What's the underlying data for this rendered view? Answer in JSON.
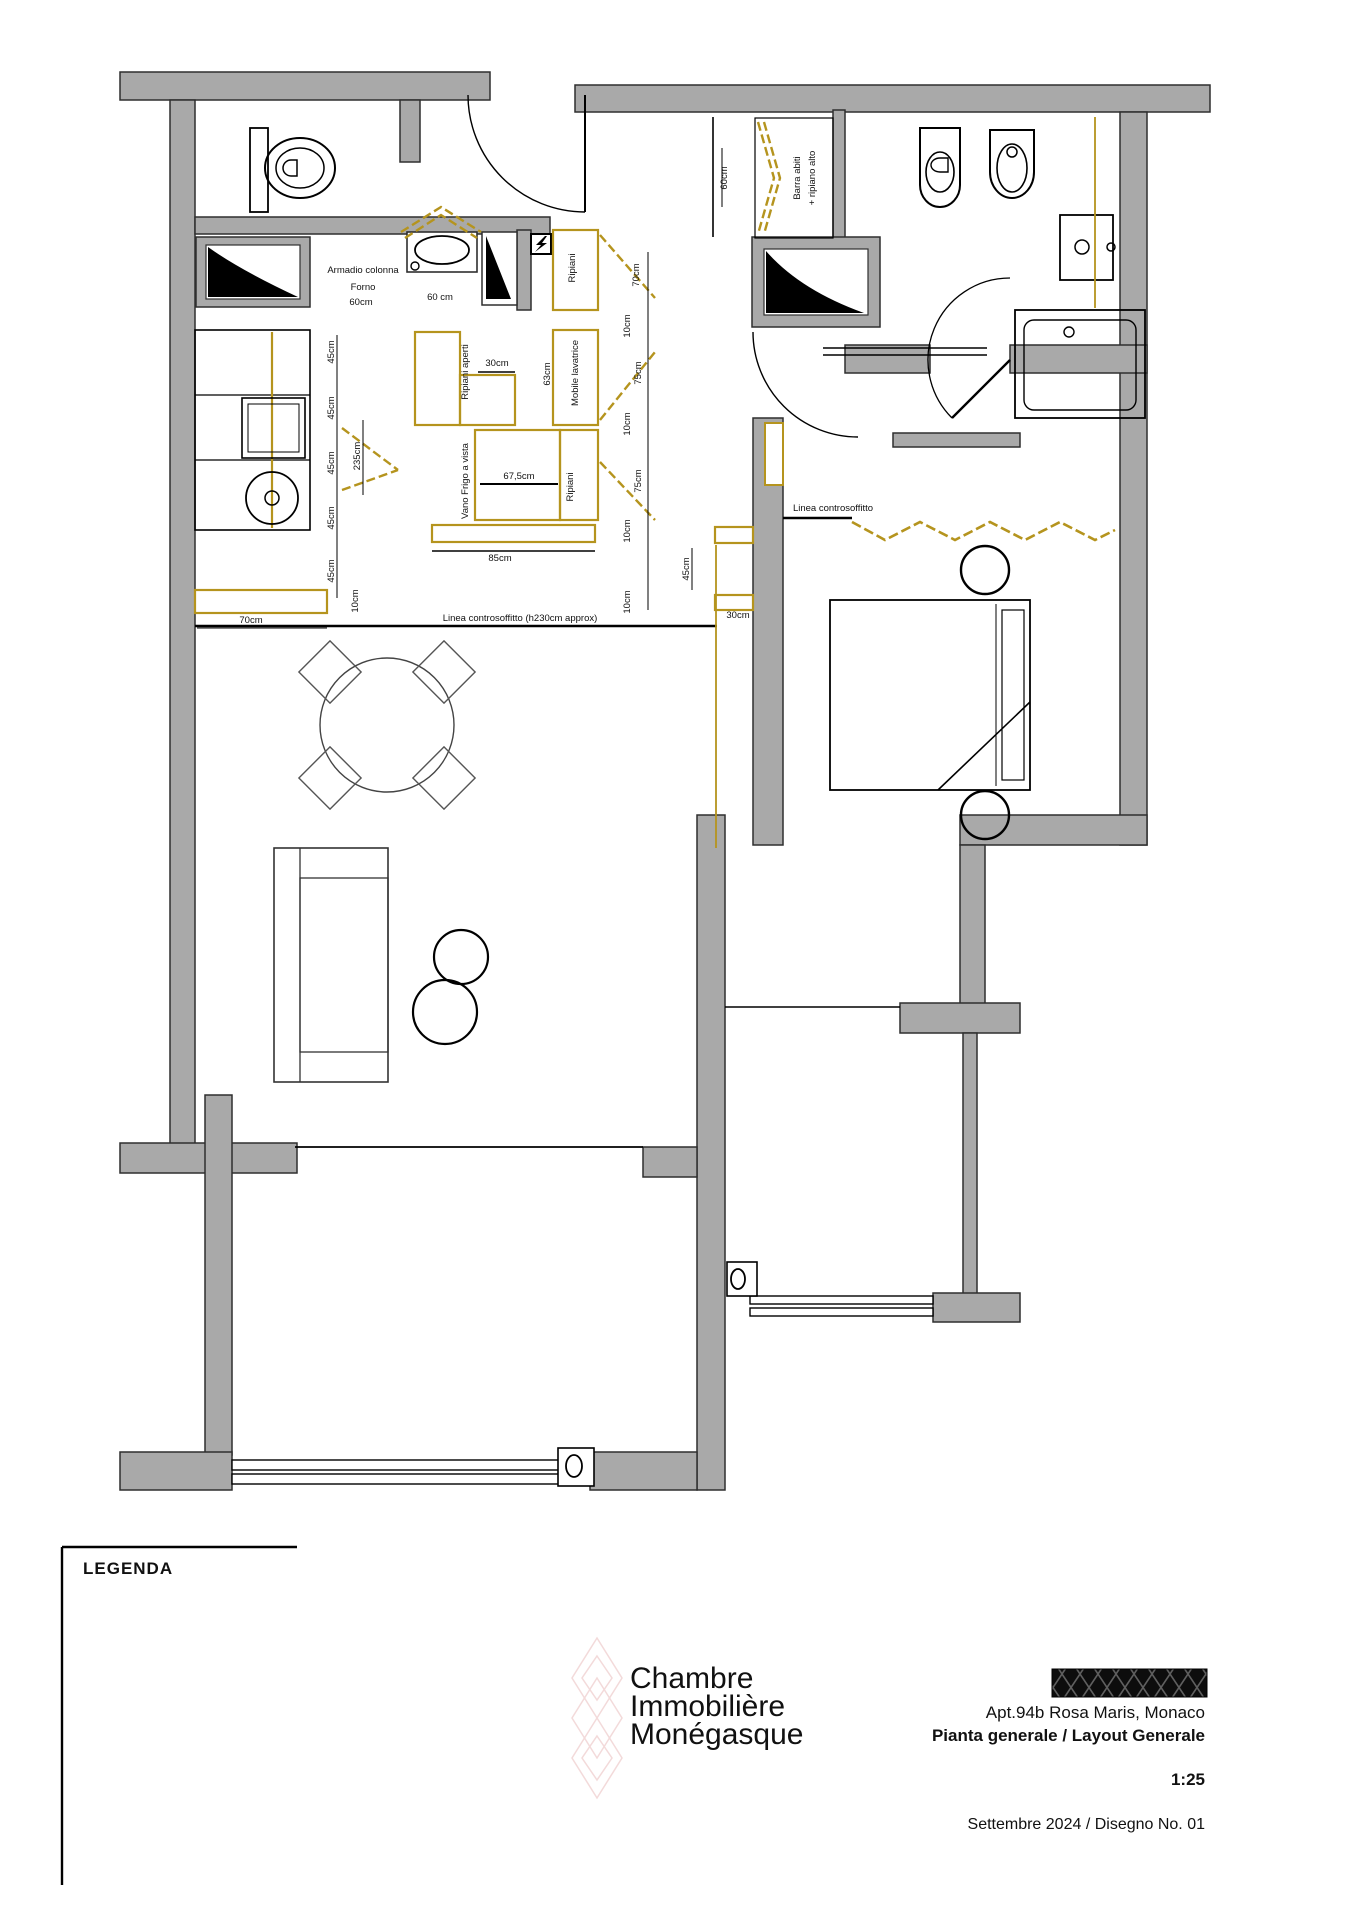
{
  "title_block": {
    "project": "Apt.94b Rosa Maris, Monaco",
    "drawing_title": "Pianta generale / Layout Generale",
    "scale": "1:25",
    "issue": "Settembre 2024 / Disegno No. 01"
  },
  "legend": {
    "title": "LEGENDA"
  },
  "watermark": {
    "line1": "Chambre",
    "line2": "Immobilière",
    "line3": "Monégasque"
  },
  "colors": {
    "wall_fill": "#a9a9a9",
    "wall_stroke": "#2f2f2f",
    "cabinet_gold": "#b5941e",
    "duct_black": "#000000",
    "watermark_pink": "#f2dcdc",
    "paper": "#ffffff"
  },
  "rooms": {
    "bathroom1": "bagno 1",
    "kitchen": "cucina",
    "entry": "ingresso",
    "closet": "guardaroba",
    "bathroom2": "bagno 2",
    "living": "soggiorno",
    "bedroom": "camera",
    "balcony1": "terrazza 1",
    "balcony2": "terrazza 2"
  },
  "plan_labels": [
    {
      "text": "Armadio colonna",
      "x": 363,
      "y": 273
    },
    {
      "text": "Forno",
      "x": 363,
      "y": 290
    },
    {
      "text": "60cm",
      "x": 361,
      "y": 305
    },
    {
      "text": "60 cm",
      "x": 440,
      "y": 300
    },
    {
      "text": "Ripiani",
      "x": 575,
      "y": 268,
      "rot": -90
    },
    {
      "text": "Ripiani aperti",
      "x": 468,
      "y": 372,
      "rot": -90
    },
    {
      "text": "30cm",
      "x": 497,
      "y": 366
    },
    {
      "text": "63cm",
      "x": 550,
      "y": 374,
      "rot": -90
    },
    {
      "text": "Mobile lavatrice",
      "x": 578,
      "y": 373,
      "rot": -90
    },
    {
      "text": "Vano Frigo a vista",
      "x": 468,
      "y": 481,
      "rot": -90
    },
    {
      "text": "67,5cm",
      "x": 519,
      "y": 479
    },
    {
      "text": "Ripiani",
      "x": 573,
      "y": 487,
      "rot": -90
    },
    {
      "text": "85cm",
      "x": 500,
      "y": 561
    },
    {
      "text": "45cm",
      "x": 334,
      "y": 352,
      "rot": -90
    },
    {
      "text": "45cm",
      "x": 334,
      "y": 408,
      "rot": -90
    },
    {
      "text": "45cm",
      "x": 334,
      "y": 463,
      "rot": -90
    },
    {
      "text": "45cm",
      "x": 334,
      "y": 518,
      "rot": -90
    },
    {
      "text": "45cm",
      "x": 334,
      "y": 571,
      "rot": -90
    },
    {
      "text": "10cm",
      "x": 358,
      "y": 601,
      "rot": -90
    },
    {
      "text": "235cm",
      "x": 360,
      "y": 456,
      "rot": -90
    },
    {
      "text": "70cm",
      "x": 639,
      "y": 275,
      "rot": -90
    },
    {
      "text": "10cm",
      "x": 630,
      "y": 326,
      "rot": -90
    },
    {
      "text": "75cm",
      "x": 641,
      "y": 373,
      "rot": -90
    },
    {
      "text": "10cm",
      "x": 630,
      "y": 424,
      "rot": -90
    },
    {
      "text": "75cm",
      "x": 641,
      "y": 481,
      "rot": -90
    },
    {
      "text": "10cm",
      "x": 630,
      "y": 531,
      "rot": -90
    },
    {
      "text": "10cm",
      "x": 630,
      "y": 602,
      "rot": -90
    },
    {
      "text": "45cm",
      "x": 689,
      "y": 569,
      "rot": -90
    },
    {
      "text": "30cm",
      "x": 738,
      "y": 618
    },
    {
      "text": "70cm",
      "x": 251,
      "y": 623
    },
    {
      "text": "Linea controsoffitto (h230cm approx)",
      "x": 520,
      "y": 621
    },
    {
      "text": "Linea controsoffitto",
      "x": 833,
      "y": 511
    },
    {
      "text": "60cm",
      "x": 727,
      "y": 178,
      "rot": -90
    },
    {
      "text": "Barra abiti",
      "x": 800,
      "y": 178,
      "rot": -90
    },
    {
      "text": "+ ripiano alto",
      "x": 815,
      "y": 178,
      "rot": -90
    }
  ]
}
